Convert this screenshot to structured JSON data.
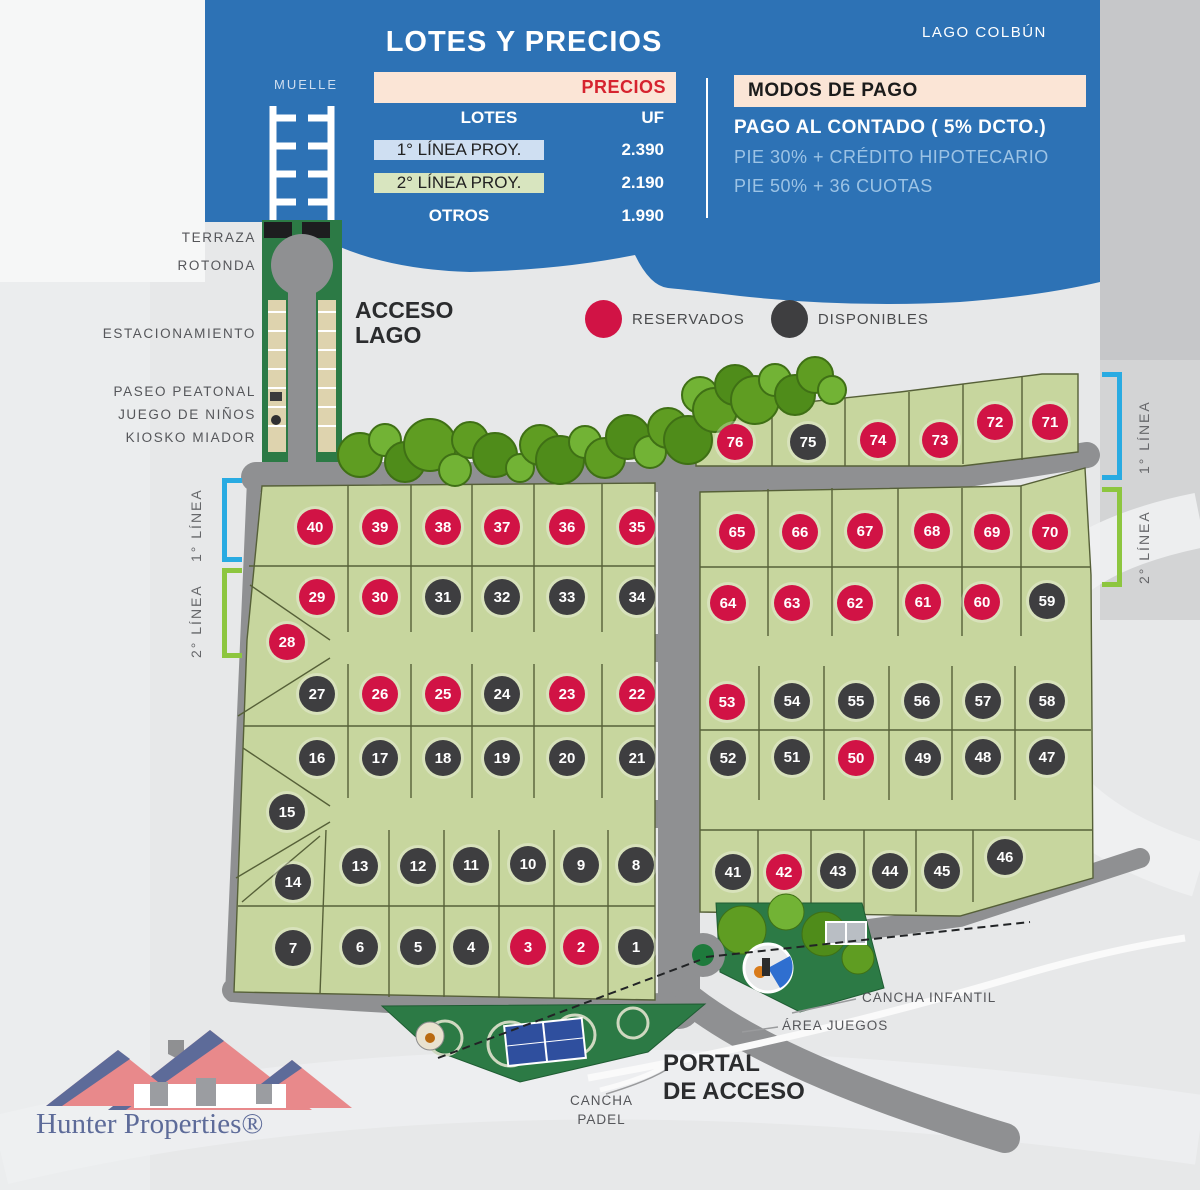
{
  "header": {
    "title": "LOTES Y PRECIOS",
    "lake_label": "LAGO COLBÚN",
    "price_table": {
      "header": "PRECIOS",
      "col_lotes": "LOTES",
      "col_uf": "UF",
      "rows": [
        {
          "label": "1° LÍNEA PROY.",
          "value": "2.390"
        },
        {
          "label": "2° LÍNEA PROY.",
          "value": "2.190"
        },
        {
          "label": "OTROS",
          "value": "1.990"
        }
      ]
    },
    "payment": {
      "title": "MODOS DE PAGO",
      "line1": "PAGO AL CONTADO ( 5% DCTO.)",
      "line2": "PIE 30% + CRÉDITO HIPOTECARIO",
      "line3": "PIE 50% + 36 CUOTAS"
    }
  },
  "access_labels": {
    "muelle": "MUELLE",
    "terraza": "TERRAZA",
    "rotonda": "ROTONDA",
    "estacionamiento": "ESTACIONAMIENTO",
    "acceso_lago_1": "ACCESO",
    "acceso_lago_2": "LAGO",
    "paseo_peatonal": "PASEO PEATONAL",
    "juego_ninos": "JUEGO DE NIÑOS",
    "kiosko": "KIOSKO MIADOR"
  },
  "legend": {
    "reserved_label": "RESERVADOS",
    "available_label": "DISPONIBLES",
    "reserved_color": "#d11345",
    "available_color": "#3e3e40"
  },
  "line_markers": {
    "first_line": "1° LÍNEA",
    "second_line": "2° LÍNEA",
    "first_color": "#29abe2",
    "second_color": "#8dc63f"
  },
  "site_labels": {
    "cancha_infantil": "CANCHA INFANTIL",
    "area_juegos": "ÁREA JUEGOS",
    "portal_1": "PORTAL",
    "portal_2": "DE ACCESO",
    "cancha_padel_1": "CANCHA",
    "cancha_padel_2": "PADEL"
  },
  "logo": {
    "brand": "Hunter Properties®"
  },
  "lots": [
    {
      "n": "40",
      "x": 315,
      "y": 527,
      "s": "r"
    },
    {
      "n": "39",
      "x": 380,
      "y": 527,
      "s": "r"
    },
    {
      "n": "38",
      "x": 443,
      "y": 527,
      "s": "r"
    },
    {
      "n": "37",
      "x": 502,
      "y": 527,
      "s": "r"
    },
    {
      "n": "36",
      "x": 567,
      "y": 527,
      "s": "r"
    },
    {
      "n": "35",
      "x": 637,
      "y": 527,
      "s": "r"
    },
    {
      "n": "29",
      "x": 317,
      "y": 597,
      "s": "r"
    },
    {
      "n": "30",
      "x": 380,
      "y": 597,
      "s": "r"
    },
    {
      "n": "31",
      "x": 443,
      "y": 597,
      "s": "a"
    },
    {
      "n": "32",
      "x": 502,
      "y": 597,
      "s": "a"
    },
    {
      "n": "33",
      "x": 567,
      "y": 597,
      "s": "a"
    },
    {
      "n": "34",
      "x": 637,
      "y": 597,
      "s": "a"
    },
    {
      "n": "28",
      "x": 287,
      "y": 642,
      "s": "r"
    },
    {
      "n": "27",
      "x": 317,
      "y": 694,
      "s": "a"
    },
    {
      "n": "26",
      "x": 380,
      "y": 694,
      "s": "r"
    },
    {
      "n": "25",
      "x": 443,
      "y": 694,
      "s": "r"
    },
    {
      "n": "24",
      "x": 502,
      "y": 694,
      "s": "a"
    },
    {
      "n": "23",
      "x": 567,
      "y": 694,
      "s": "r"
    },
    {
      "n": "22",
      "x": 637,
      "y": 694,
      "s": "r"
    },
    {
      "n": "16",
      "x": 317,
      "y": 758,
      "s": "a"
    },
    {
      "n": "17",
      "x": 380,
      "y": 758,
      "s": "a"
    },
    {
      "n": "18",
      "x": 443,
      "y": 758,
      "s": "a"
    },
    {
      "n": "19",
      "x": 502,
      "y": 758,
      "s": "a"
    },
    {
      "n": "20",
      "x": 567,
      "y": 758,
      "s": "a"
    },
    {
      "n": "21",
      "x": 637,
      "y": 758,
      "s": "a"
    },
    {
      "n": "15",
      "x": 287,
      "y": 812,
      "s": "a"
    },
    {
      "n": "14",
      "x": 293,
      "y": 882,
      "s": "a"
    },
    {
      "n": "13",
      "x": 360,
      "y": 866,
      "s": "a"
    },
    {
      "n": "12",
      "x": 418,
      "y": 866,
      "s": "a"
    },
    {
      "n": "11",
      "x": 471,
      "y": 865,
      "s": "a"
    },
    {
      "n": "10",
      "x": 528,
      "y": 864,
      "s": "a"
    },
    {
      "n": "9",
      "x": 581,
      "y": 865,
      "s": "a"
    },
    {
      "n": "8",
      "x": 636,
      "y": 865,
      "s": "a"
    },
    {
      "n": "7",
      "x": 293,
      "y": 948,
      "s": "a"
    },
    {
      "n": "6",
      "x": 360,
      "y": 947,
      "s": "a"
    },
    {
      "n": "5",
      "x": 418,
      "y": 947,
      "s": "a"
    },
    {
      "n": "4",
      "x": 471,
      "y": 947,
      "s": "a"
    },
    {
      "n": "3",
      "x": 528,
      "y": 947,
      "s": "r"
    },
    {
      "n": "2",
      "x": 581,
      "y": 947,
      "s": "r"
    },
    {
      "n": "1",
      "x": 636,
      "y": 947,
      "s": "a"
    },
    {
      "n": "76",
      "x": 735,
      "y": 442,
      "s": "r"
    },
    {
      "n": "75",
      "x": 808,
      "y": 442,
      "s": "a"
    },
    {
      "n": "74",
      "x": 878,
      "y": 440,
      "s": "r"
    },
    {
      "n": "73",
      "x": 940,
      "y": 440,
      "s": "r"
    },
    {
      "n": "72",
      "x": 995,
      "y": 422,
      "s": "r"
    },
    {
      "n": "71",
      "x": 1050,
      "y": 422,
      "s": "r"
    },
    {
      "n": "65",
      "x": 737,
      "y": 532,
      "s": "r"
    },
    {
      "n": "66",
      "x": 800,
      "y": 532,
      "s": "r"
    },
    {
      "n": "67",
      "x": 865,
      "y": 531,
      "s": "r"
    },
    {
      "n": "68",
      "x": 932,
      "y": 531,
      "s": "r"
    },
    {
      "n": "69",
      "x": 992,
      "y": 532,
      "s": "r"
    },
    {
      "n": "70",
      "x": 1050,
      "y": 532,
      "s": "r"
    },
    {
      "n": "64",
      "x": 728,
      "y": 603,
      "s": "r"
    },
    {
      "n": "63",
      "x": 792,
      "y": 603,
      "s": "r"
    },
    {
      "n": "62",
      "x": 855,
      "y": 603,
      "s": "r"
    },
    {
      "n": "61",
      "x": 923,
      "y": 602,
      "s": "r"
    },
    {
      "n": "60",
      "x": 982,
      "y": 602,
      "s": "r"
    },
    {
      "n": "59",
      "x": 1047,
      "y": 601,
      "s": "a"
    },
    {
      "n": "53",
      "x": 727,
      "y": 702,
      "s": "r"
    },
    {
      "n": "54",
      "x": 792,
      "y": 701,
      "s": "a"
    },
    {
      "n": "55",
      "x": 856,
      "y": 701,
      "s": "a"
    },
    {
      "n": "56",
      "x": 922,
      "y": 701,
      "s": "a"
    },
    {
      "n": "57",
      "x": 983,
      "y": 701,
      "s": "a"
    },
    {
      "n": "58",
      "x": 1047,
      "y": 701,
      "s": "a"
    },
    {
      "n": "52",
      "x": 728,
      "y": 758,
      "s": "a"
    },
    {
      "n": "51",
      "x": 792,
      "y": 757,
      "s": "a"
    },
    {
      "n": "50",
      "x": 856,
      "y": 758,
      "s": "r"
    },
    {
      "n": "49",
      "x": 923,
      "y": 758,
      "s": "a"
    },
    {
      "n": "48",
      "x": 983,
      "y": 757,
      "s": "a"
    },
    {
      "n": "47",
      "x": 1047,
      "y": 757,
      "s": "a"
    },
    {
      "n": "41",
      "x": 733,
      "y": 872,
      "s": "a"
    },
    {
      "n": "42",
      "x": 784,
      "y": 872,
      "s": "r"
    },
    {
      "n": "43",
      "x": 838,
      "y": 871,
      "s": "a"
    },
    {
      "n": "44",
      "x": 890,
      "y": 871,
      "s": "a"
    },
    {
      "n": "45",
      "x": 942,
      "y": 871,
      "s": "a"
    },
    {
      "n": "46",
      "x": 1005,
      "y": 857,
      "s": "a"
    }
  ]
}
